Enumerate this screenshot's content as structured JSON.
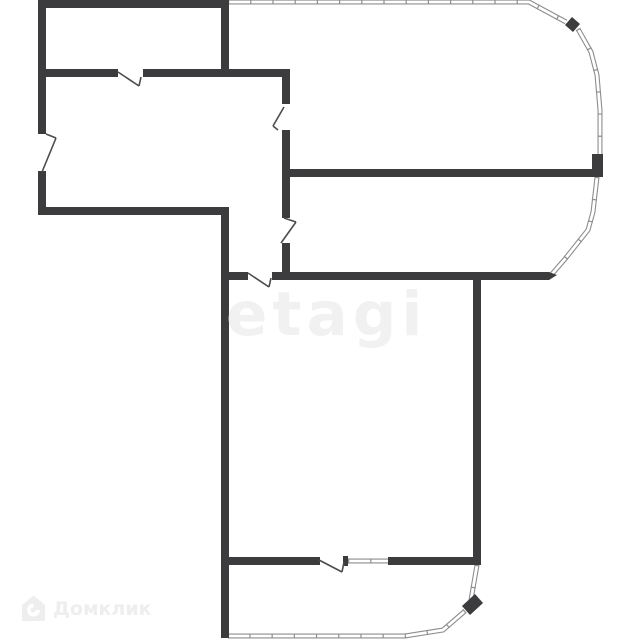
{
  "canvas": {
    "width": 640,
    "height": 640,
    "background": "#ffffff"
  },
  "colors": {
    "wall": "#3c3c3e",
    "window_line": "#8d8d8d",
    "window_fill": "#ffffff",
    "door_line": "#4c4c4c",
    "watermark_etagi": "#f1f1f1",
    "watermark_domclick": "#eeeeee"
  },
  "watermarks": {
    "etagi": "etagi",
    "domclick": "Домклик",
    "domclick_icon": "house-icon"
  },
  "floorplan": {
    "walls": [
      [
        38,
        0,
        8,
        134
      ],
      [
        38,
        171,
        8,
        44
      ],
      [
        38,
        0,
        190,
        8
      ],
      [
        221,
        0,
        8,
        77
      ],
      [
        38,
        69,
        80,
        8
      ],
      [
        143,
        69,
        147,
        8
      ],
      [
        282,
        69,
        8,
        35
      ],
      [
        282,
        130,
        8,
        88
      ],
      [
        282,
        243,
        8,
        33
      ],
      [
        286,
        169,
        307,
        8
      ],
      [
        592,
        154,
        11,
        23
      ],
      [
        221,
        272,
        27,
        8
      ],
      [
        272,
        272,
        277,
        8
      ],
      [
        221,
        207,
        8,
        431
      ],
      [
        38,
        207,
        191,
        8
      ],
      [
        473,
        276,
        8,
        289
      ],
      [
        221,
        557,
        99,
        8
      ],
      [
        343,
        556,
        5,
        10
      ],
      [
        388,
        557,
        89,
        8
      ]
    ],
    "blocks": [
      [
        [
          565,
          25
        ],
        [
          572,
          17
        ],
        [
          580,
          24
        ],
        [
          573,
          32
        ]
      ],
      [
        [
          462,
          606
        ],
        [
          475,
          594
        ],
        [
          483,
          603
        ],
        [
          470,
          615
        ]
      ],
      [
        [
          549,
          272
        ],
        [
          557,
          275
        ],
        [
          549,
          280
        ]
      ]
    ],
    "windows": [
      {
        "pts": [
          [
            228,
            2
          ],
          [
            529,
            2
          ],
          [
            566,
            22
          ]
        ]
      },
      {
        "pts": [
          [
            578,
            29
          ],
          [
            591,
            52
          ],
          [
            597,
            75
          ],
          [
            600,
            110
          ],
          [
            600,
            154
          ]
        ]
      },
      {
        "pts": [
          [
            597,
            177
          ],
          [
            593,
            212
          ],
          [
            588,
            230
          ],
          [
            565,
            259
          ],
          [
            552,
            274
          ]
        ]
      },
      {
        "pts": [
          [
            477,
            565
          ],
          [
            471,
            600
          ]
        ]
      },
      {
        "pts": [
          [
            465,
            611
          ],
          [
            443,
            630
          ],
          [
            405,
            636
          ],
          [
            228,
            636
          ]
        ]
      },
      {
        "pts": [
          [
            348,
            561
          ],
          [
            389,
            561
          ]
        ]
      }
    ],
    "doors": [
      [
        118,
        72,
        139,
        86
      ],
      [
        139,
        86,
        141,
        77
      ],
      [
        46,
        134,
        56,
        138
      ],
      [
        56,
        138,
        42,
        172
      ],
      [
        284,
        107,
        273,
        126
      ],
      [
        273,
        126,
        278,
        130
      ],
      [
        284,
        218,
        296,
        222
      ],
      [
        296,
        222,
        281,
        243
      ],
      [
        248,
        273,
        269,
        287
      ],
      [
        269,
        287,
        271,
        278
      ],
      [
        319,
        560,
        342,
        572
      ],
      [
        342,
        572,
        344,
        562
      ]
    ]
  }
}
